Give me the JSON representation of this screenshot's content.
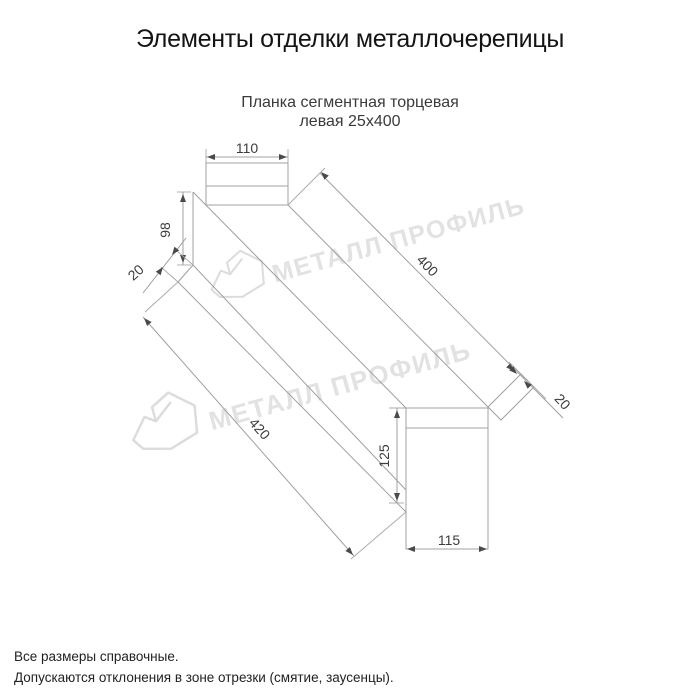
{
  "page": {
    "title": "Элементы отделки металлочерепицы",
    "subtitle_line1": "Планка сегментная торцевая",
    "subtitle_line2": "левая 25х400",
    "footer_line1": "Все размеры справочные.",
    "footer_line2": "Допускаются отклонения в зоне отрезки (смятие, заусенцы)."
  },
  "drawing": {
    "type": "technical-dimension-diagram",
    "part_name": "Планка сегментная торцевая левая 25х400",
    "dimensions": {
      "top_flange_width": "110",
      "left_web_height": "98",
      "left_fold": "20",
      "top_edge_length": "400",
      "bottom_edge_length": "420",
      "right_fold": "20",
      "right_web_height": "125",
      "bottom_flange_width": "115"
    },
    "watermark_text": "МЕТАЛЛ ПРОФИЛЬ"
  },
  "colors": {
    "background": "#ffffff",
    "line": "#a0a0a0",
    "dimension_text": "#3d3d3d",
    "watermark": "#e2e2e2",
    "title_text": "#141414"
  }
}
